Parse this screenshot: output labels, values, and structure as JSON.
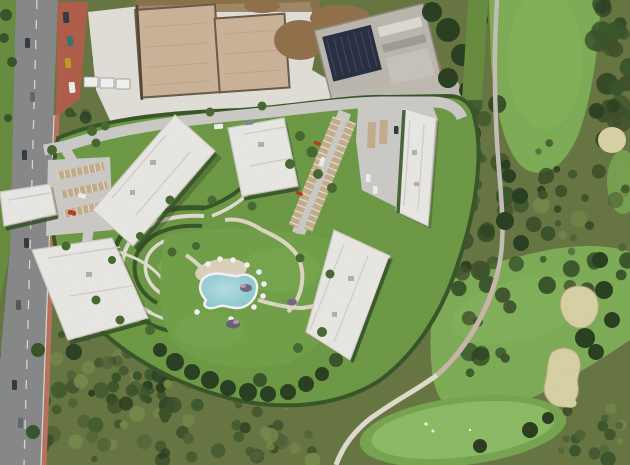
{
  "scene": {
    "type": "satellite-aerial-photograph",
    "description": "Aerial view of a resort residential development beside a golf course: six white flat-roof apartment blocks around landscaped terraced gardens and a kidney-shaped pool with white parasols; carport parking rows; an active construction site with two concrete slab foundations, a building with a dark solar-panel roof and a white gravel staging yard at the top; a two-lane asphalt road with red sidewalks and parked cars on the west; golf fairways, sand bunkers, a putting green and winding cart paths on the east; Mediterranean scrubland in between.",
    "visible_text": "none"
  },
  "palette": {
    "scrub_base": "#6d7d46",
    "scrub_dark": "#55683a",
    "scrub_darker": "#43552e",
    "tree_dark": "#2e4424",
    "tree_mid": "#3d5a2e",
    "verge_green": "#6e9544",
    "fairway": "#85b65c",
    "fairway_light": "#8fbd63",
    "putting_green": "#94c56b",
    "green_fringe": "#7fae57",
    "lawn_dev": "#74a24b",
    "lawn_bright": "#82b258",
    "hedge": "#3c5c2c",
    "sand": "#e3dcae",
    "road_asphalt": "#8f9091",
    "sidewalk_red": "#b96450",
    "gravel": "#eceae3",
    "slab_tan": "#d6bda2",
    "slab_edge": "#70604e",
    "dirt": "#9a7850",
    "concrete": "#c6c1b8",
    "solar_roof": "#2b3347",
    "building_white": "#f5f4f0",
    "building_shade": "#d9d6cd",
    "dev_road": "#d7d5d1",
    "path_cream": "#ece7da",
    "path_pink": "#d5bfb4",
    "pool_water": "#8ed2da",
    "pool_light": "#c0e9ee",
    "pool_rim": "#ffffff",
    "carport_tan": "#cdb794",
    "deck_tan": "#e7ddc6",
    "car_red": "#c33b2f",
    "car_white": "#fafafa",
    "car_dark": "#3a3f44",
    "bin_teal": "#3e7d72",
    "bin_yellow": "#c9a227"
  },
  "features": {
    "apartment_buildings": {
      "count": 6,
      "roof": "white flat roofs"
    },
    "swimming_pool": {
      "shape": "kidney",
      "parasol_count": 10
    },
    "parking": {
      "carport_rows": 7,
      "visible_cars": "several white, red and dark vehicles"
    },
    "construction_site": {
      "elements": [
        "concrete slab foundation",
        "concrete slab foundation",
        "building with solar-panel roof",
        "white gravel staging yard",
        "site trailers",
        "earth mounds"
      ]
    },
    "golf_course": {
      "elements": [
        "upper fairway",
        "lower fairway",
        "putting green",
        "cart paths",
        "sand bunkers"
      ],
      "bunker_count": 4
    },
    "main_road": {
      "lanes": 2,
      "sidewalks": "terracotta red",
      "markings": "white dashed centerline"
    }
  }
}
